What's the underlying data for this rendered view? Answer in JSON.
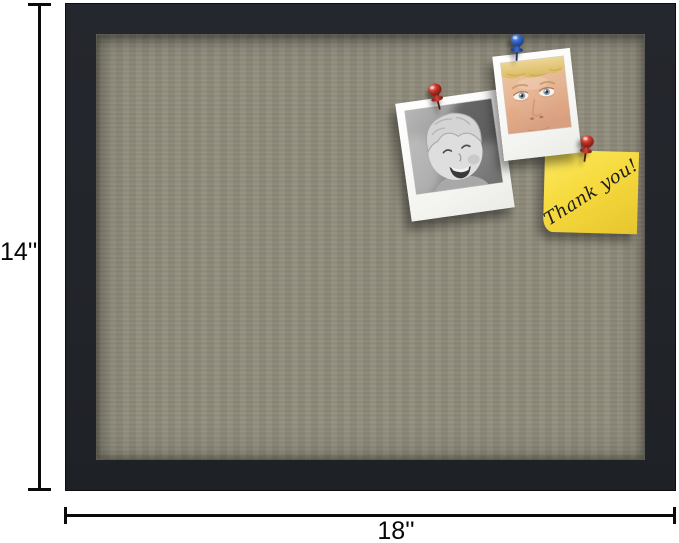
{
  "image": {
    "subject": "Black framed fabric bulletin board product photo with size annotations"
  },
  "dimensions": {
    "height_label": "14''",
    "width_label": "18''",
    "line_color": "#0a0a0a"
  },
  "board": {
    "frame_color": "#22252a",
    "fabric_color": "#8e8a7d"
  },
  "pinned_items": {
    "bw_polaroid_subject": "black-and-white polaroid of a laughing child",
    "color_polaroid_subject": "color polaroid close-up of a blond child's face",
    "sticky_note_text": "Thank you!",
    "sticky_note_color": "#f6da3e",
    "pushpin_blue_color": "#3265c8",
    "pushpin_red_color": "#c23327"
  }
}
